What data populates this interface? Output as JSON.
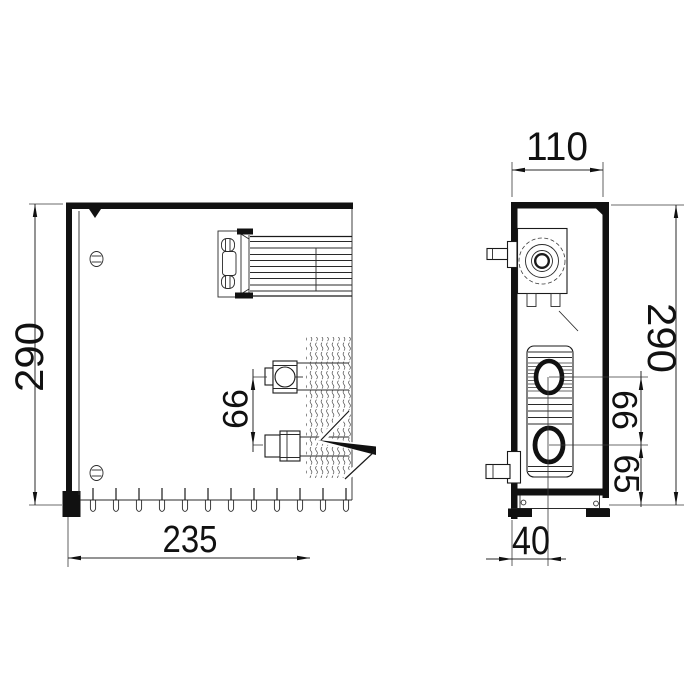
{
  "colors": {
    "line": "#1a1a1a",
    "background": "#ffffff"
  },
  "dimensions": {
    "front_height": "290",
    "front_width": "235",
    "front_pipe_spacing": "66",
    "side_depth": "110",
    "side_height": "290",
    "side_pipe_spacing": "66",
    "side_pipe_to_base": "65",
    "side_pipe_axis_offset": "40"
  }
}
